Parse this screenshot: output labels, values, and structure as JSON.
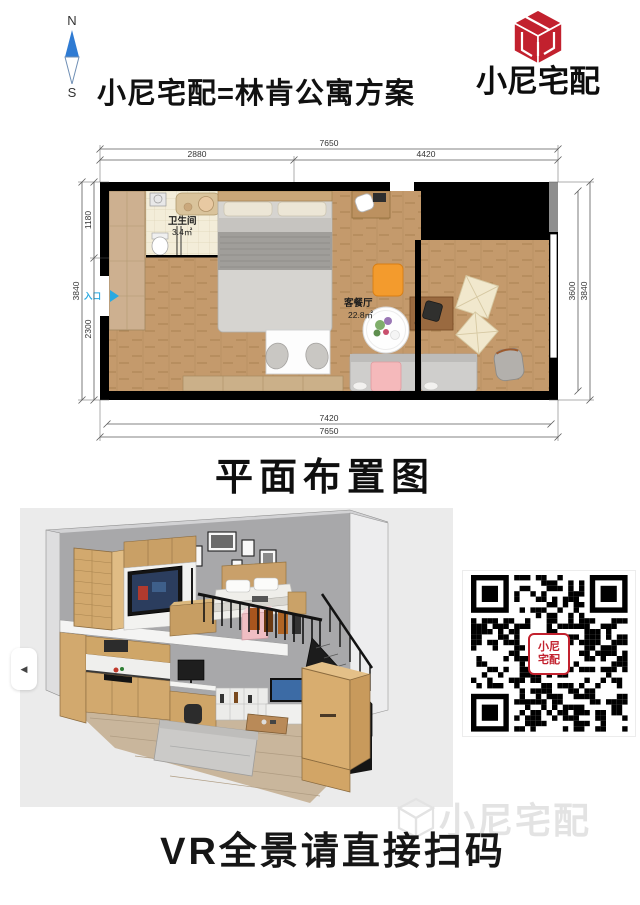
{
  "header": {
    "compass": {
      "north": "N",
      "south": "S"
    },
    "title": "小尼宅配=林肯公寓方案",
    "brand_text": "小尼宅配"
  },
  "floor_plan": {
    "caption": "平面布置图",
    "bathroom": {
      "name": "卫生间",
      "area": "3.4㎡"
    },
    "living": {
      "name": "客餐厅",
      "area": "22.8㎡"
    },
    "entry_label": "入口",
    "dims": {
      "top_total": "7650",
      "top_left": "2880",
      "top_right": "4420",
      "bottom_inner": "7420",
      "bottom_total": "7650",
      "left_outer": "3840",
      "left_upper": "1180",
      "left_lower": "2300",
      "right_inner": "3600",
      "right_outer": "3840"
    }
  },
  "viewer": {
    "collapse_icon": "◀"
  },
  "qr": {
    "label_line1": "小尼",
    "label_line2": "宅配"
  },
  "footer": {
    "cta": "VR全景请直接扫码",
    "watermark": "小尼宅配"
  },
  "colors": {
    "brand_red": "#c2212e",
    "compass_blue": "#2f7bd3",
    "entry_blue": "#29a9e1",
    "wall_black": "#000000",
    "wood_floor": "#c49a6c",
    "bath_floor": "#f3edd9"
  }
}
